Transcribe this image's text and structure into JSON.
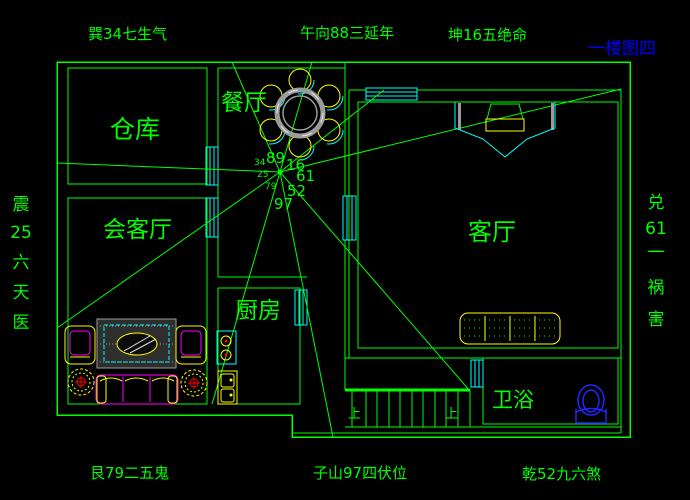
{
  "drawing": {
    "sheet_label": "一楼图四",
    "palette": {
      "line_green": "#00ff00",
      "window_cyan": "#00ffff",
      "furniture_yellow": "#ffff00",
      "furniture_magenta": "#ff00ff",
      "accent_red": "#ff0000",
      "fixture_blue": "#2424ff",
      "metal_gray": "#9c9c9c",
      "sheet_label_blue": "#0000ff",
      "background": "#000000"
    },
    "annotations": {
      "top_left": "巽34七生气",
      "top_center": "午向88三延年",
      "top_right": "坤16五绝命",
      "bottom_left": "艮79二五鬼",
      "bottom_center": "子山97四伏位",
      "bottom_right": "乾52九六煞",
      "left_column": [
        "震",
        "25",
        "六",
        "天",
        "医"
      ],
      "right_column": [
        "兑",
        "61",
        "一",
        "祸",
        "害"
      ]
    },
    "center_numbers": {
      "n": "89",
      "ne": "16",
      "e": "61",
      "se": "52",
      "s": "97",
      "nw_small": "34",
      "w_small": "25",
      "sw_small": "79"
    },
    "rooms": {
      "storage": "仓库",
      "reception": "会客厅",
      "dining": "餐厅",
      "kitchen": "厨房",
      "living": "客厅",
      "bathroom": "卫浴"
    },
    "stairs": {
      "left_up": "上",
      "right_up": "上"
    }
  }
}
